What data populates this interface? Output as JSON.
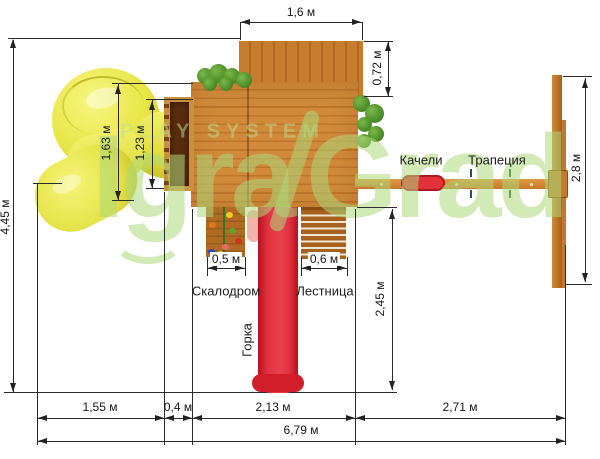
{
  "watermark": {
    "play_system": "PLAY SYSTEM",
    "brand_left": "Igra",
    "brand_right": "Grad"
  },
  "labels": {
    "climbing_wall": "Скалодром",
    "ladder": "Лестница",
    "slide": "Горка",
    "swing": "Качели",
    "trapeze": "Трапеция"
  },
  "dimensions": {
    "total_depth": "4,45 м",
    "roof_width": "1,6 м",
    "roof_depth": "0,72 м",
    "tube_outer": "1,63 м",
    "tube_inner": "1,23 м",
    "climb_width": "0,5 м",
    "ladder_width": "0,6 м",
    "slide_run": "2,45 м",
    "swing_frame": "2,8 м",
    "span_tube": "1,55 м",
    "span_balcony": "0,4 м",
    "span_platform": "2,13 м",
    "span_swing": "2,71 м",
    "total_width": "6,79 м"
  },
  "colors": {
    "wood": "#c9873b",
    "roof": "#c0762b",
    "slide_red": "#d9252f",
    "tube_yellow": "#e7e548",
    "bush_green": "#4e8f2a",
    "watermark_green": "#add87a",
    "dim_line": "#2b2b2b"
  }
}
